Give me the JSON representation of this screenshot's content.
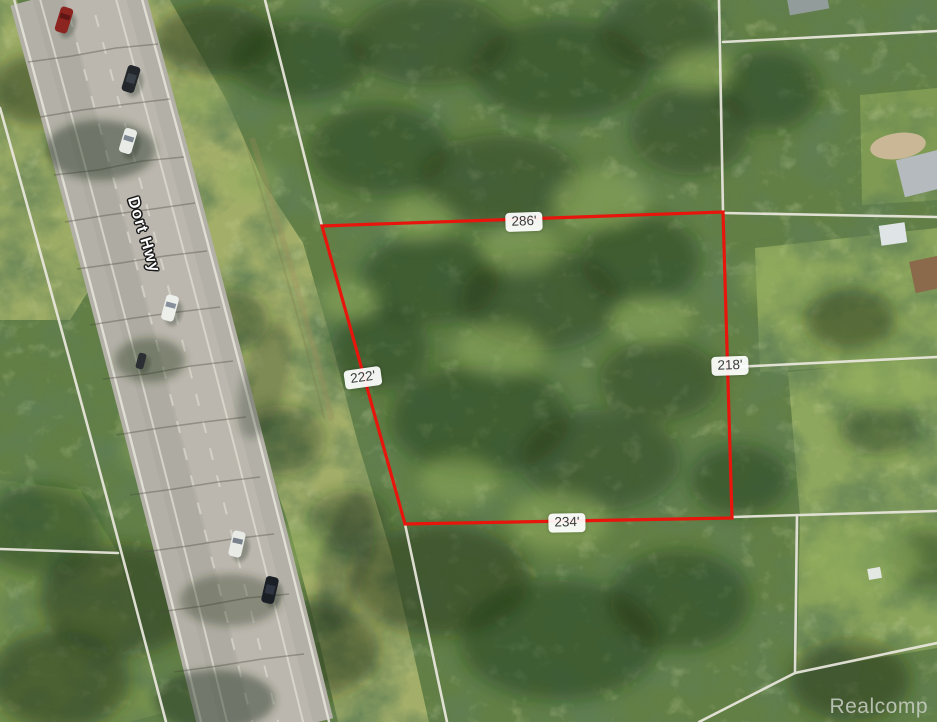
{
  "map": {
    "type": "aerial-satellite-parcel-view",
    "road": {
      "name": "Dort Hwy"
    },
    "watermark": "Realcomp",
    "parcel": {
      "boundary_color": "#e8150c",
      "dimensions": {
        "top": "286'",
        "left": "222'",
        "right": "218'",
        "bottom": "234'"
      }
    },
    "property_line_color": "#e9e7de",
    "vehicles": [
      {
        "location": "road-north",
        "color": "dark-red"
      },
      {
        "location": "road-north",
        "color": "black"
      },
      {
        "location": "road-north",
        "color": "white"
      },
      {
        "location": "road-middle",
        "color": "white"
      },
      {
        "location": "road-middle",
        "color": "dark"
      },
      {
        "location": "road-south",
        "color": "white"
      },
      {
        "location": "road-south",
        "color": "black"
      }
    ]
  }
}
